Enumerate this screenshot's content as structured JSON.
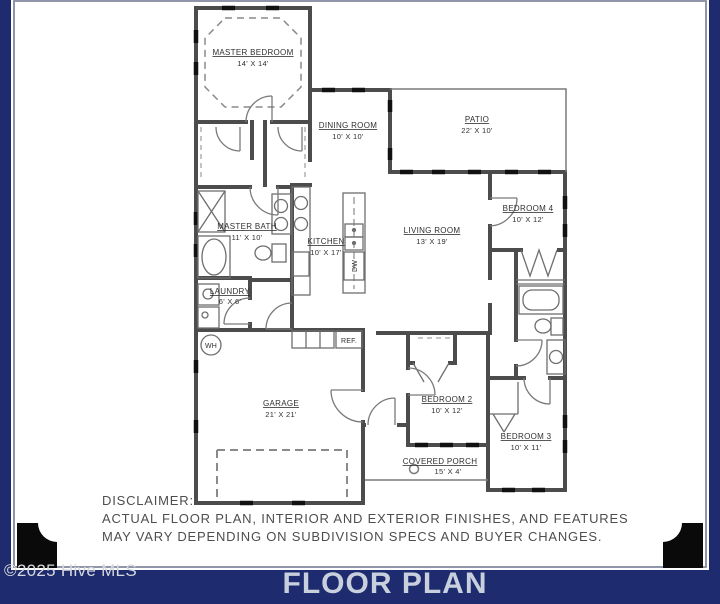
{
  "colors": {
    "navy": "#1e2b6f",
    "wall_gray": "#4c4c4c",
    "window_black": "#111111",
    "footer_text": "#c9d0dd",
    "watermark_text": "#d6d8dc",
    "ornament_black": "#0a0a0a"
  },
  "watermark": {
    "text": "©2025 Hive MLS"
  },
  "footer": {
    "title": "FLOOR PLAN"
  },
  "disclaimer": {
    "label": "DISCLAIMER:",
    "line1": "ACTUAL FLOOR PLAN, INTERIOR AND EXTERIOR FINISHES, AND FEATURES",
    "line2": "MAY VARY DEPENDING ON SUBDIVISION SPECS AND BUYER CHANGES."
  },
  "rooms": {
    "master_bedroom": {
      "name": "MASTER BEDROOM",
      "dims": "14' X 14'"
    },
    "dining_room": {
      "name": "DINING ROOM",
      "dims": "10' X 10'"
    },
    "patio": {
      "name": "PATIO",
      "dims": "22' X 10'"
    },
    "bedroom_4": {
      "name": "BEDROOM 4",
      "dims": "10' X 12'"
    },
    "living_room": {
      "name": "LIVING ROOM",
      "dims": "13' X 19'"
    },
    "kitchen": {
      "name": "KITCHEN",
      "dims": "10' X 17'"
    },
    "master_bath": {
      "name": "MASTER BATH",
      "dims": "11' X 10'"
    },
    "laundry": {
      "name": "LAUNDRY",
      "dims": "6' X 6'"
    },
    "garage": {
      "name": "GARAGE",
      "dims": "21' X 21'"
    },
    "bedroom_2": {
      "name": "BEDROOM 2",
      "dims": "10' X 12'"
    },
    "bedroom_3": {
      "name": "BEDROOM 3",
      "dims": "10' X 11'"
    },
    "covered_porch": {
      "name": "COVERED PORCH",
      "dims": "15' X 4'"
    }
  },
  "fixtures": {
    "water_heater": "WH",
    "dishwasher": "DW",
    "refrigerator": "REF."
  }
}
